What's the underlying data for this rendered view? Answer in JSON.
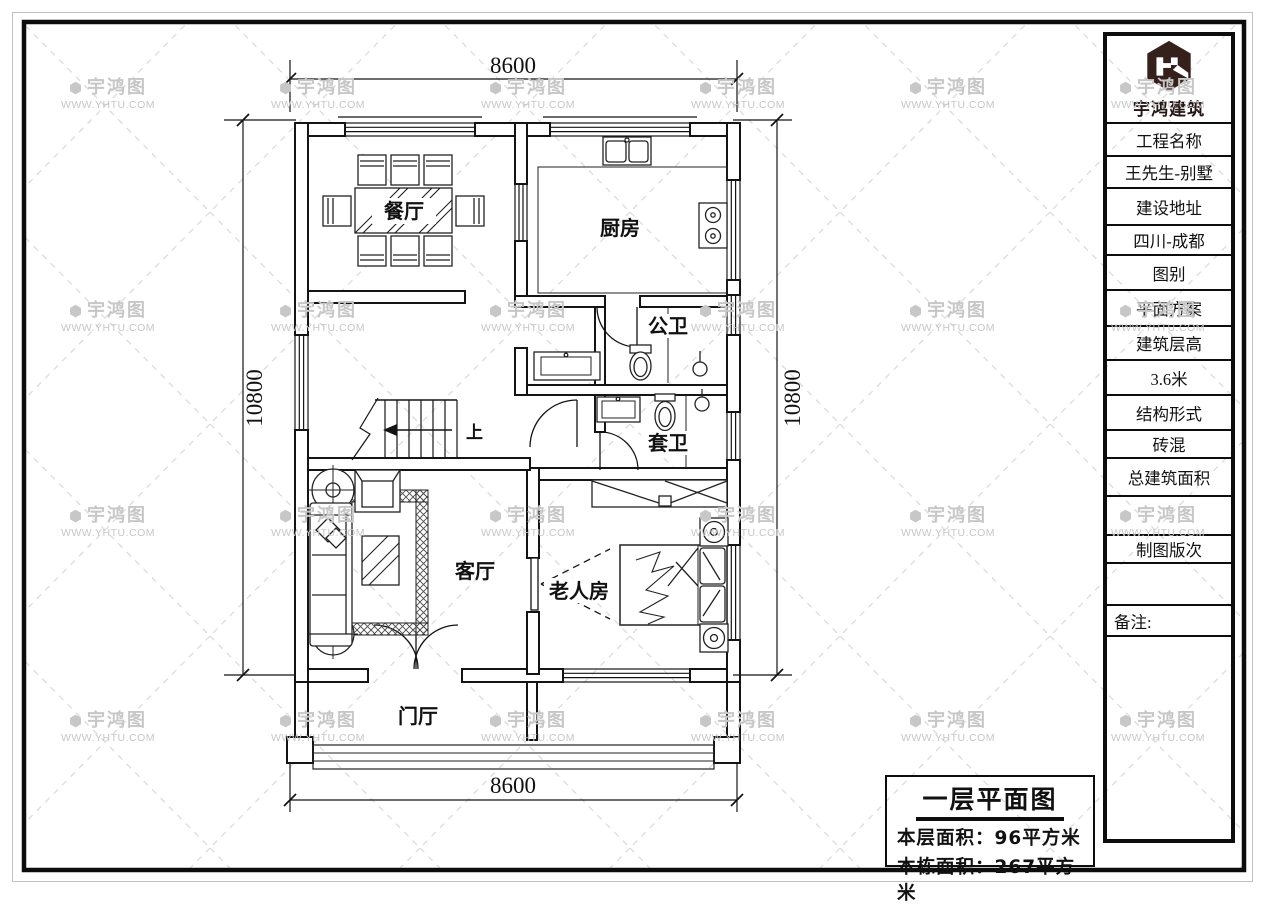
{
  "watermark": {
    "brand": "宇鸿图",
    "url": "WWW.YHTU.COM"
  },
  "title_block": {
    "company": "宇鸿建筑",
    "rows": [
      {
        "text": "工程名称"
      },
      {
        "text": "王先生-别墅"
      },
      {
        "text": "建设地址"
      },
      {
        "text": "四川-成都"
      },
      {
        "text": "图别"
      },
      {
        "text": "平面方案"
      },
      {
        "text": "建筑层高"
      },
      {
        "text": "3.6米"
      },
      {
        "text": "结构形式"
      },
      {
        "text": "砖混"
      },
      {
        "text": "总建筑面积"
      },
      {
        "text": ""
      },
      {
        "text": "制图版次"
      },
      {
        "text": ""
      },
      {
        "text": "备注:"
      },
      {
        "text": ""
      }
    ]
  },
  "plan": {
    "rooms": {
      "dining": "餐厅",
      "kitchen": "厨房",
      "public_bath": "公卫",
      "ensuite_bath": "套卫",
      "living": "客厅",
      "elder": "老人房",
      "foyer": "门厅"
    },
    "stair_label": "上",
    "dimensions": {
      "top": "8600",
      "bottom": "8600",
      "left": "10800",
      "right": "10800"
    }
  },
  "footer": {
    "title": "一层平面图",
    "floor_area": "本层面积：96平方米",
    "building_area": "本栋面积：267平方米"
  }
}
